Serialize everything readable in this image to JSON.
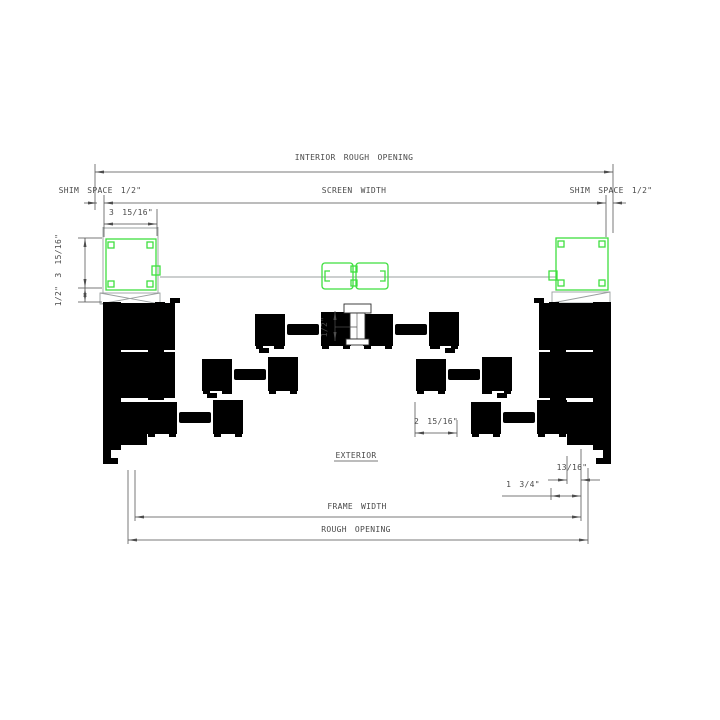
{
  "drawing": {
    "kind": "horizontal-section-detail-multi-slide-door",
    "dims": {
      "interior_rough_opening": "INTERIOR ROUGH OPENING",
      "screen_width": "SCREEN WIDTH",
      "shim_space_left": "SHIM SPACE 1/2\"",
      "shim_space_right": "SHIM SPACE 1/2\"",
      "screen_box_width": "3 15/16\"",
      "screen_box_depth_vertical": "1/2\" 3 15/16\"",
      "center_interlock_gap": "1/2\"",
      "stile_width": "2 15/16\"",
      "exterior_label": "EXTERIOR",
      "jamb_offset": "13/16\"",
      "pocket_offset": "1 3/4\"",
      "frame_width": "FRAME WIDTH",
      "rough_opening": "ROUGH OPENING"
    },
    "colors": {
      "screen_highlight": "#3fdf3f",
      "frame_line": "#2e2e2e",
      "dimension_line": "#4d4d4d",
      "screen_mesh_line": "#9a9f9f",
      "background": "#ffffff"
    }
  }
}
